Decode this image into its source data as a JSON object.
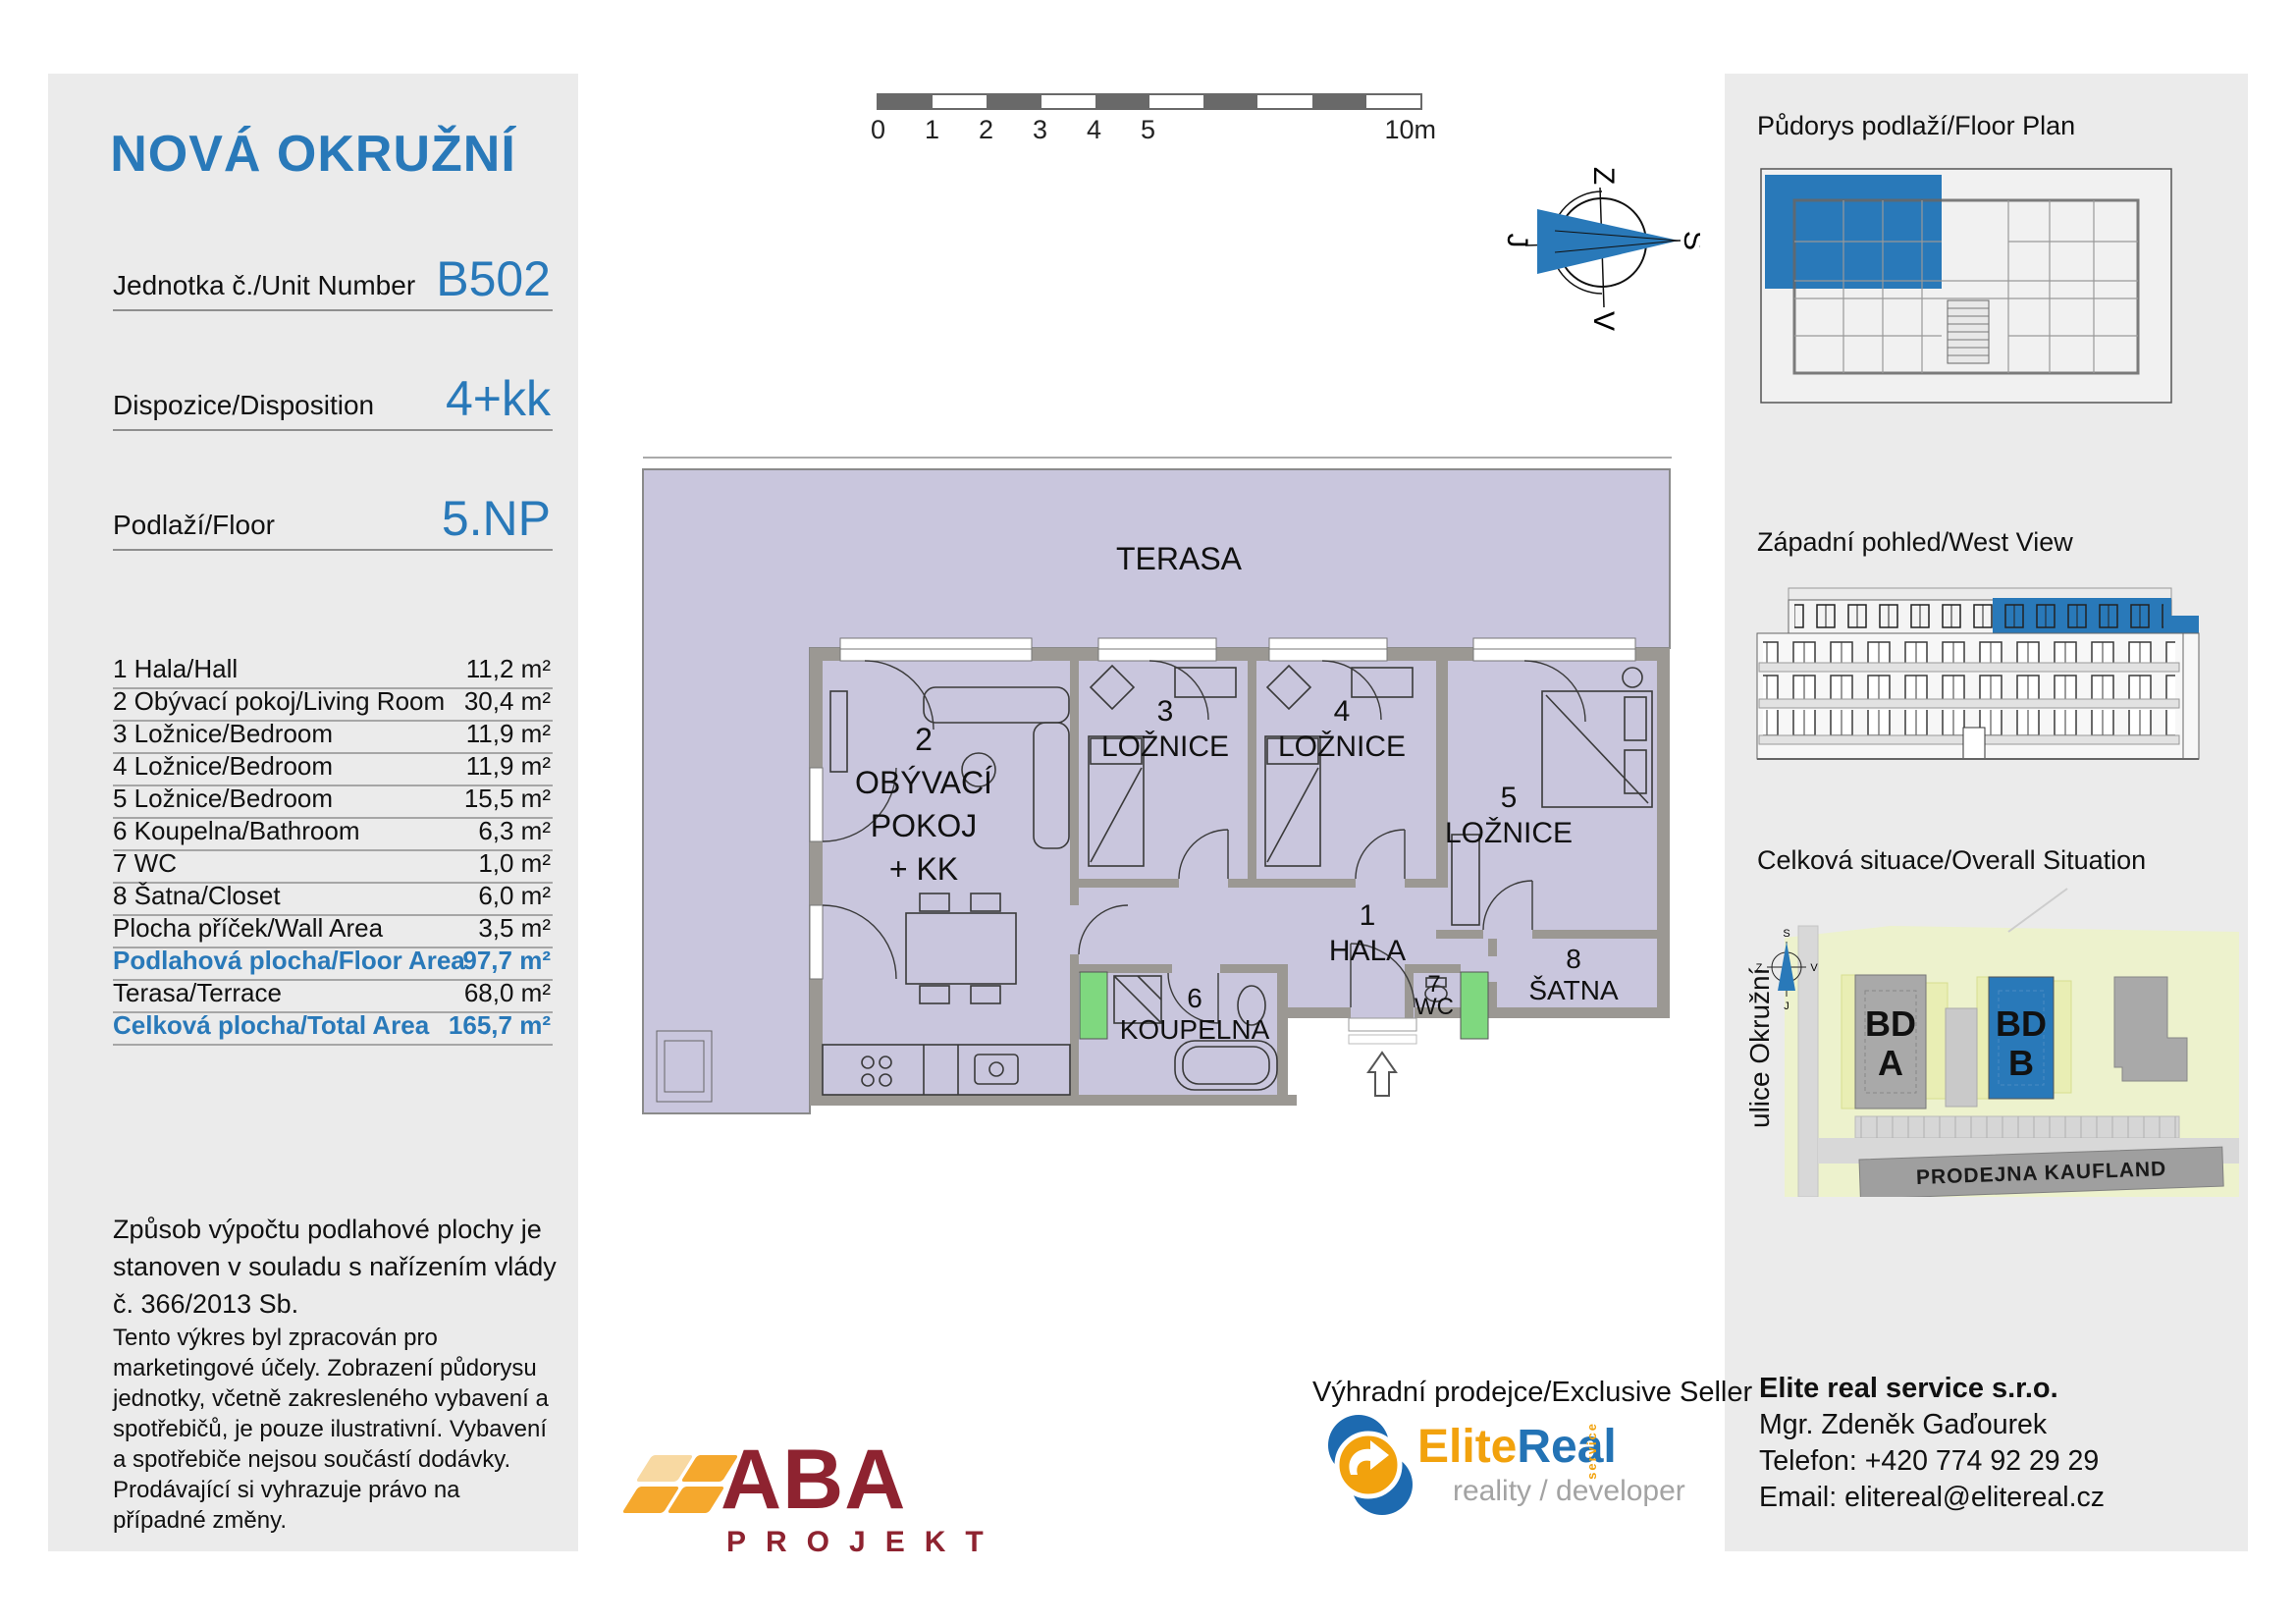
{
  "colors": {
    "accent_blue": "#2979b9",
    "panel_gray": "#ebebeb",
    "plan_fill_lavender": "#c9c6dd",
    "wall_gray": "#9b9893",
    "shaft_green": "#7fd87f",
    "aba_red": "#8e2330",
    "aba_orange": "#f5a82d",
    "aba_orange_light": "#f8d9a2",
    "elitereal_blue": "#1d6ab0",
    "elitereal_orange": "#f2a20d",
    "situation_green": "#edf2cd",
    "building_gray": "#a9a9a9",
    "road_gray": "#d8d8d8"
  },
  "left_panel": {
    "title": "NOVÁ OKRUŽNÍ",
    "info_rows": [
      {
        "label": "Jednotka č./Unit Number",
        "value": "B502"
      },
      {
        "label": "Dispozice/Disposition",
        "value": "4+kk"
      },
      {
        "label": "Podlaží/Floor",
        "value": "5.NP"
      }
    ],
    "area_rows": [
      {
        "label": "1 Hala/Hall",
        "value": "11,2 m²"
      },
      {
        "label": "2 Obývací pokoj/Living Room",
        "value": "30,4 m²"
      },
      {
        "label": "3 Ložnice/Bedroom",
        "value": "11,9 m²"
      },
      {
        "label": "4 Ložnice/Bedroom",
        "value": "11,9 m²"
      },
      {
        "label": "5 Ložnice/Bedroom",
        "value": "15,5 m²"
      },
      {
        "label": "6 Koupelna/Bathroom",
        "value": "6,3 m²"
      },
      {
        "label": "7 WC",
        "value": "1,0 m²"
      },
      {
        "label": "8 Šatna/Closet",
        "value": "6,0 m²"
      },
      {
        "label": "Plocha příček/Wall Area",
        "value": "3,5 m²"
      },
      {
        "label": "Podlahová plocha/Floor Area",
        "value": "97,7 m²"
      },
      {
        "label": "Terasa/Terrace",
        "value": "68,0 m²"
      },
      {
        "label": "Celková plocha/Total Area",
        "value": "165,7 m²"
      }
    ],
    "note1": "Způsob výpočtu podlahové plochy je stanoven v souladu s nařízením vlády č. 366/2013 Sb.",
    "note2": "Tento výkres byl zpracován pro marketingové účely. Zobrazení půdorysu jednotky, včetně zakresleného vybavení a spotřebičů, je pouze ilustrativní. Vybavení a spotřebiče nejsou součástí dodávky. Prodávající si vyhrazuje právo na případné změny."
  },
  "scale_bar": {
    "labels": [
      "0",
      "1",
      "2",
      "3",
      "4",
      "5"
    ],
    "end_label": "10m"
  },
  "compass": {
    "top": "Z",
    "right": "S",
    "bottom": "V",
    "left": "J"
  },
  "floor_plan": {
    "terrace": "TERASA",
    "living": {
      "num": "2",
      "l1": "OBÝVACÍ",
      "l2": "POKOJ",
      "l3": "+ KK"
    },
    "bedroom3": {
      "num": "3",
      "name": "LOŽNICE"
    },
    "bedroom4": {
      "num": "4",
      "name": "LOŽNICE"
    },
    "bedroom5": {
      "num": "5",
      "name": "LOŽNICE"
    },
    "hall": {
      "num": "1",
      "name": "HALA"
    },
    "bathroom": {
      "num": "6",
      "name": "KOUPELNA"
    },
    "wc": {
      "num": "7",
      "name": "WC"
    },
    "closet": {
      "num": "8",
      "name": "ŠATNA"
    }
  },
  "right_panel": {
    "floor_plan_heading": "Půdorys podlaží/Floor Plan",
    "west_view_heading": "Západní pohled/West View",
    "situation_heading": "Celková situace/Overall Situation",
    "situation": {
      "street": "ulice Okružní",
      "bd_a1": "BD",
      "bd_a2": "A",
      "bd_b1": "BD",
      "bd_b2": "B",
      "kaufland": "PRODEJNA KAUFLAND",
      "compass": {
        "top": "S",
        "right": "V",
        "bottom": "J",
        "left": "Z"
      }
    },
    "contact": {
      "company": "Elite real service s.r.o.",
      "person": "Mgr. Zdeněk Gaďourek",
      "phone": "Telefon: +420 774 92 29 29",
      "email": "Email: elitereal@elitereal.cz"
    }
  },
  "footer": {
    "seller_heading": "Výhradní prodejce/Exclusive Seller",
    "aba": {
      "name": "ABA",
      "sub": "PROJEKT"
    },
    "elitereal": {
      "elite": "Elite",
      "real": "Real",
      "service": "service",
      "tagline": "reality / developer"
    }
  }
}
